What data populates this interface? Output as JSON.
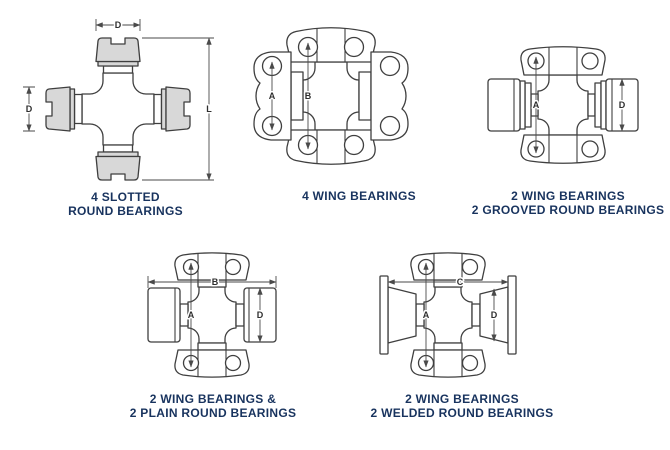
{
  "title": "Universal joint bearing style diagrams",
  "colors": {
    "background": "#ffffff",
    "line": "#3f3f3f",
    "dimension_line": "#4a4a4a",
    "caption_text": "#18335e",
    "bearing_fill": "#d8d8d8"
  },
  "figures": [
    {
      "id": "4-slotted-round-bearings",
      "caption_lines": [
        "4 SLOTTED",
        "ROUND BEARINGS"
      ],
      "dims": {
        "d_top": "D",
        "d_left": "D",
        "l_right": "L"
      }
    },
    {
      "id": "4-wing-bearings",
      "caption_lines": [
        "4 WING BEARINGS"
      ],
      "dims": {
        "a": "A",
        "b": "B"
      }
    },
    {
      "id": "2-wing-2-grooved-round-bearings",
      "caption_lines": [
        "2 WING BEARINGS",
        "2 GROOVED ROUND BEARINGS"
      ],
      "dims": {
        "a": "A",
        "d": "D"
      }
    },
    {
      "id": "2-wing-2-plain-round-bearings",
      "caption_lines": [
        "2 WING BEARINGS &",
        "2 PLAIN ROUND BEARINGS"
      ],
      "dims": {
        "a": "A",
        "b": "B",
        "d": "D"
      }
    },
    {
      "id": "2-wing-2-welded-round-bearings",
      "caption_lines": [
        "2 WING BEARINGS",
        "2 WELDED ROUND BEARINGS"
      ],
      "dims": {
        "a": "A",
        "c": "C",
        "d": "D"
      }
    }
  ]
}
